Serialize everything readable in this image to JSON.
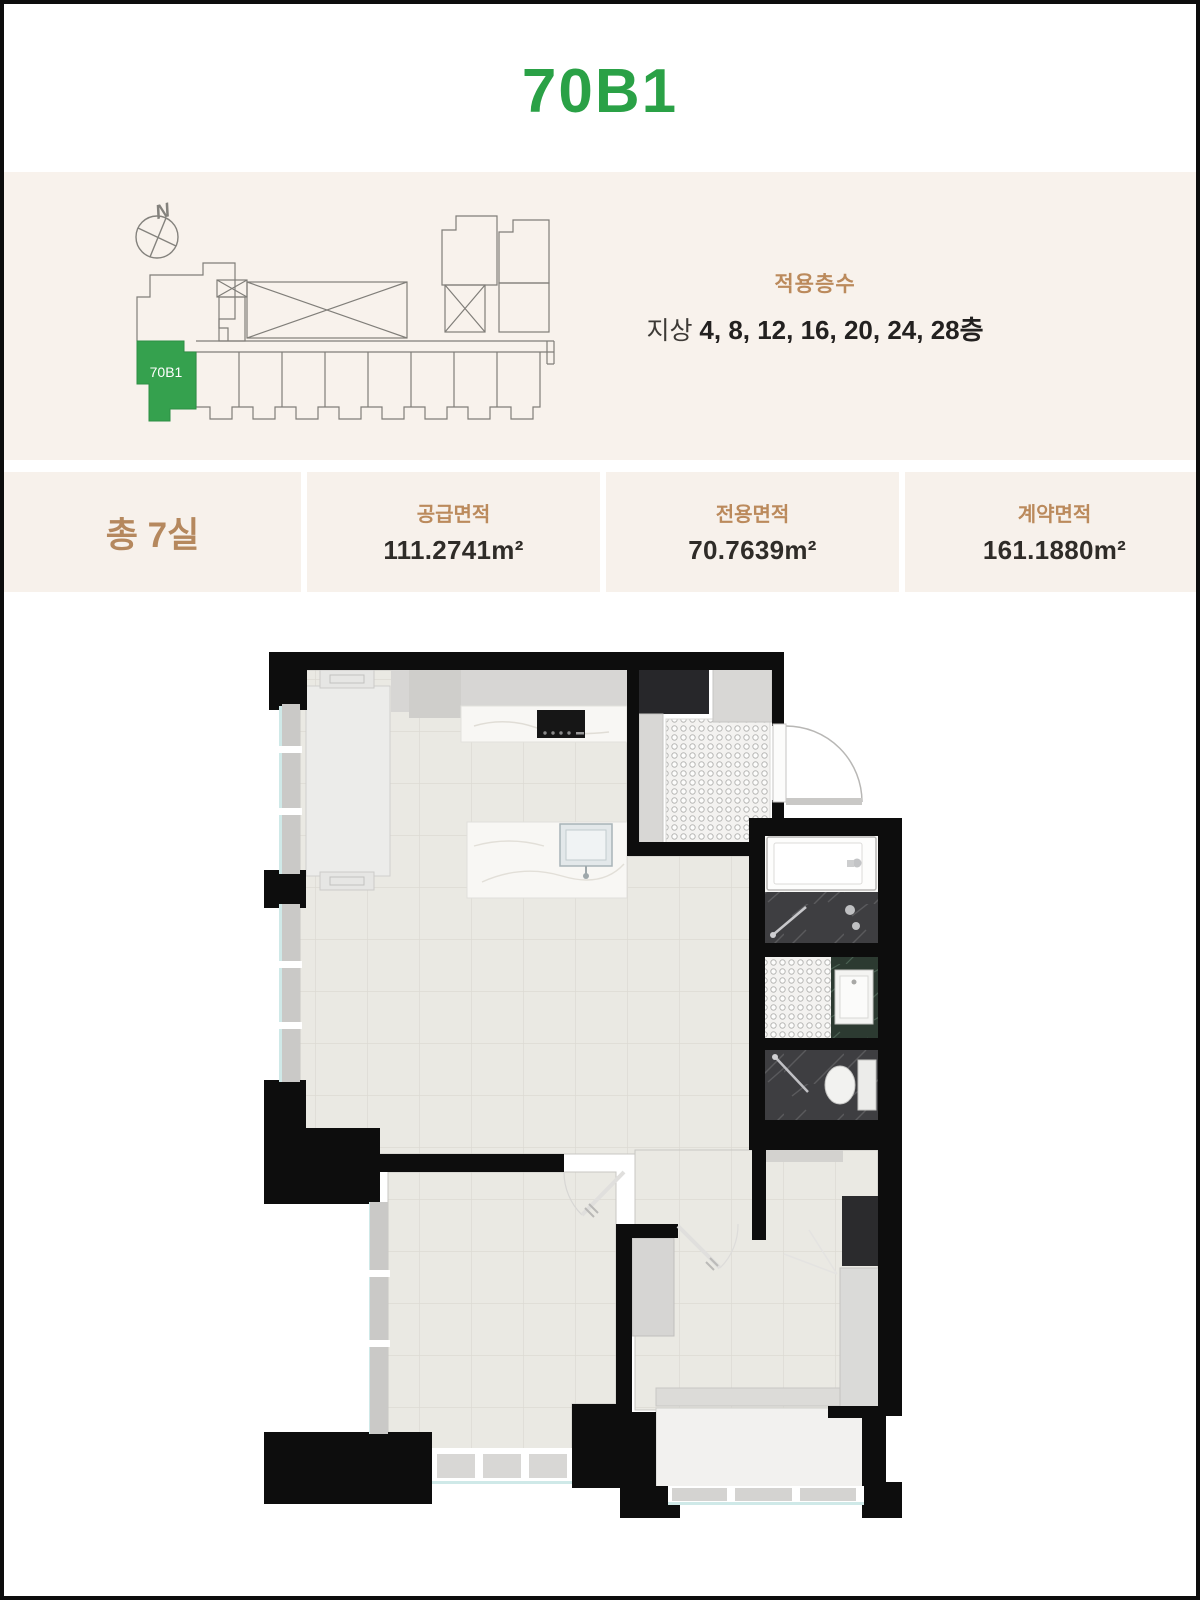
{
  "page": {
    "title": "70B1"
  },
  "colors": {
    "title_green": "#2aa146",
    "unit_green": "#35a14e",
    "label_tan": "#bb8a5c",
    "value_dark": "#2f2c28",
    "band_beige": "#f8f2ec",
    "wall_black": "#0d0d0d"
  },
  "site_plan": {
    "north_label": "N",
    "unit_tag": "70B1",
    "floors_label": "적용층수",
    "floors_prefix": "지상 ",
    "floors_numbers": "4, 8, 12, 16, 20, 24, 28층"
  },
  "info": {
    "total_rooms": "총 7실",
    "areas": [
      {
        "label": "공급면적",
        "value": "111.2741m²"
      },
      {
        "label": "전용면적",
        "value": "70.7639m²"
      },
      {
        "label": "계약면적",
        "value": "161.1880m²"
      }
    ]
  }
}
